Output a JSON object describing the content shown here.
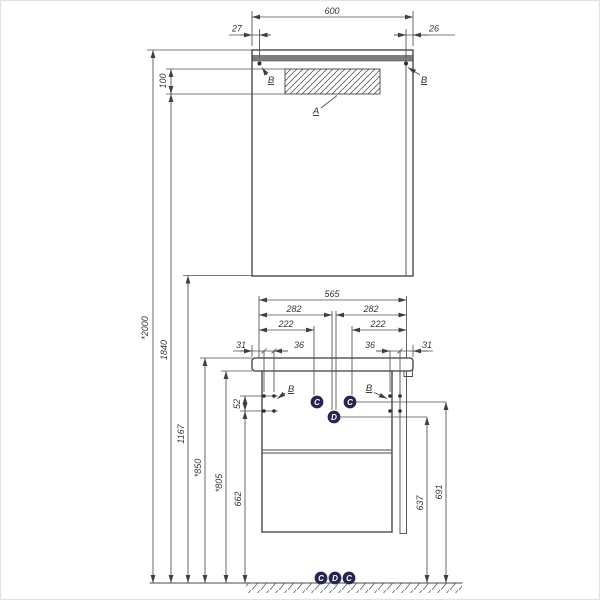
{
  "labels": {
    "a": "A",
    "b": "B",
    "c": "C",
    "d": "D"
  },
  "mirror": {
    "width": "600",
    "offset_left": "27",
    "offset_right": "26",
    "lamp_height": "100"
  },
  "heights": {
    "total": "*2000",
    "h1840": "1840",
    "h1167": "1167",
    "h850": "*850",
    "h805": "*805",
    "h662": "662",
    "h52": "52",
    "h637": "637",
    "h691": "691"
  },
  "vanity": {
    "width": "565",
    "half_left": "282",
    "half_right": "282",
    "c_left": "222",
    "c_right": "222",
    "edge_left": "31",
    "screw_left": "36",
    "screw_right": "36",
    "edge_right": "31"
  },
  "colors": {
    "line": "#3c3c3c",
    "dim": "#4f4f4f",
    "badge": "#26264e",
    "lamp": "#7d7d7d"
  }
}
